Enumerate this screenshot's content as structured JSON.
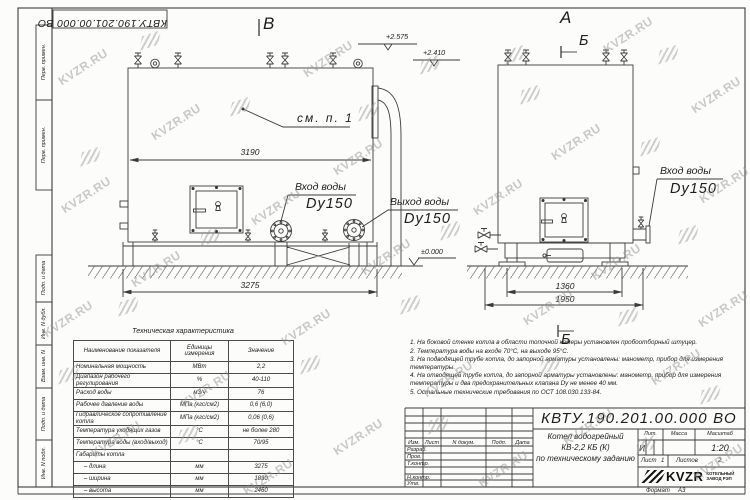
{
  "watermark": {
    "text": "KVZR.RU"
  },
  "stamp_top": {
    "doc_number": "КВТУ.190.201.00.000 ВО"
  },
  "margin": {
    "top_box1": "Перв. примен.",
    "top_box2": "Перв. примен.",
    "box_podp1": "Подп. и дата",
    "box_inv_dubl": "Инв. N дубл.",
    "box_vzam": "Взам. инв. N",
    "box_podp2": "Подп. и дата",
    "box_inv_podl": "Инв. N подл."
  },
  "drawing": {
    "view_main": {
      "view_label": "В",
      "elev_top1": "+2.575",
      "elev_top2": "+2.410",
      "elev_zero": "±0.000",
      "dim_inner_width": "3190",
      "dim_outer_width": "3275",
      "see_note": "см. п. 1",
      "inlet_line1": "Вход воды",
      "inlet_line2": "Dy150",
      "outlet_line1": "Выход воды",
      "outlet_line2": "Dy150"
    },
    "view_side": {
      "view_label": "А",
      "section_label_top": "Б",
      "section_label_bottom": "Б",
      "dim_inner_width": "1360",
      "dim_outer_width": "1950",
      "inlet_line1": "Вход воды",
      "inlet_line2": "Dy150"
    }
  },
  "tech_table": {
    "title": "Техническая характеристика",
    "col_name": "Наименование показателя",
    "col_units": "Единицы измерения",
    "col_value": "Значение",
    "rows": [
      {
        "name": "Номинальная мощность",
        "units": "МВт",
        "value": "2,2"
      },
      {
        "name": "Диапазон рабочего регулирования",
        "units": "%",
        "value": "40-110"
      },
      {
        "name": "Расход воды",
        "units": "м3/ч",
        "value": "76"
      },
      {
        "name": "Рабочее давление воды",
        "units": "МПа (кгс/см2)",
        "value": "0,6 (6,0)"
      },
      {
        "name": "Гидравлическое сопротивление котла",
        "units": "МПа (кгс/см2)",
        "value": "0,06 (0,6)"
      },
      {
        "name": "Температура уходящих газов",
        "units": "°С",
        "value": "не более 280"
      },
      {
        "name": "Температура воды (вход/выход)",
        "units": "°С",
        "value": "70/95"
      },
      {
        "name": "Габариты котла",
        "units": "",
        "value": ""
      },
      {
        "name": "– длина",
        "units": "мм",
        "value": "3275"
      },
      {
        "name": "– ширина",
        "units": "мм",
        "value": "1830"
      },
      {
        "name": "– высота",
        "units": "мм",
        "value": "2460"
      }
    ]
  },
  "notes": [
    "1.  На боковой стенке котла в области топочной камеры установлен пробоотборный штуцер.",
    "2.  Температура воды на входе 70°С, на выходе 95°С.",
    "3.  На подводящей трубе котла, до запорной арматуры установлены: манометр, прибор для измерения температуры.",
    "4.  На отводящей трубе котла, до запорной арматуры установлены: манометр, прибор для измерения температуры и два предохранительных клапана Dу не менее 40 мм.",
    "5.  Остальные технические требования по ОСТ 108.030.133-84."
  ],
  "title_block": {
    "doc_number": "КВТУ.190.201.00.000  ВО",
    "product_line1": "Котел водогрейный",
    "product_line2": "КВ-2,2 КБ (К)",
    "product_line3": "по техническому заданию",
    "col_izm": "Изм.",
    "col_list": "Лист",
    "col_ndoc": "N докум.",
    "col_podp": "Подп.",
    "col_data": "Дата",
    "row_razrab": "Разраб.",
    "row_prov": "Пров.",
    "row_tkontr": "Т.контр.",
    "row_nkontr": "Н.контр.",
    "row_utv": "Утв.",
    "lit_label": "Лит.",
    "lit_value": "И",
    "mass_label": "Масса",
    "scale_label": "Масштаб",
    "scale_value": "1:20",
    "sheet_label": "Лист",
    "sheet_value": "1",
    "sheets_label": "Листов",
    "sheets_value": "2",
    "logo_name": "KVZR",
    "logo_sub1": "КОТЕЛЬНЫЙ",
    "logo_sub2": "ЗАВОД РЭП",
    "format_label": "Формат",
    "format_value": "А3"
  }
}
